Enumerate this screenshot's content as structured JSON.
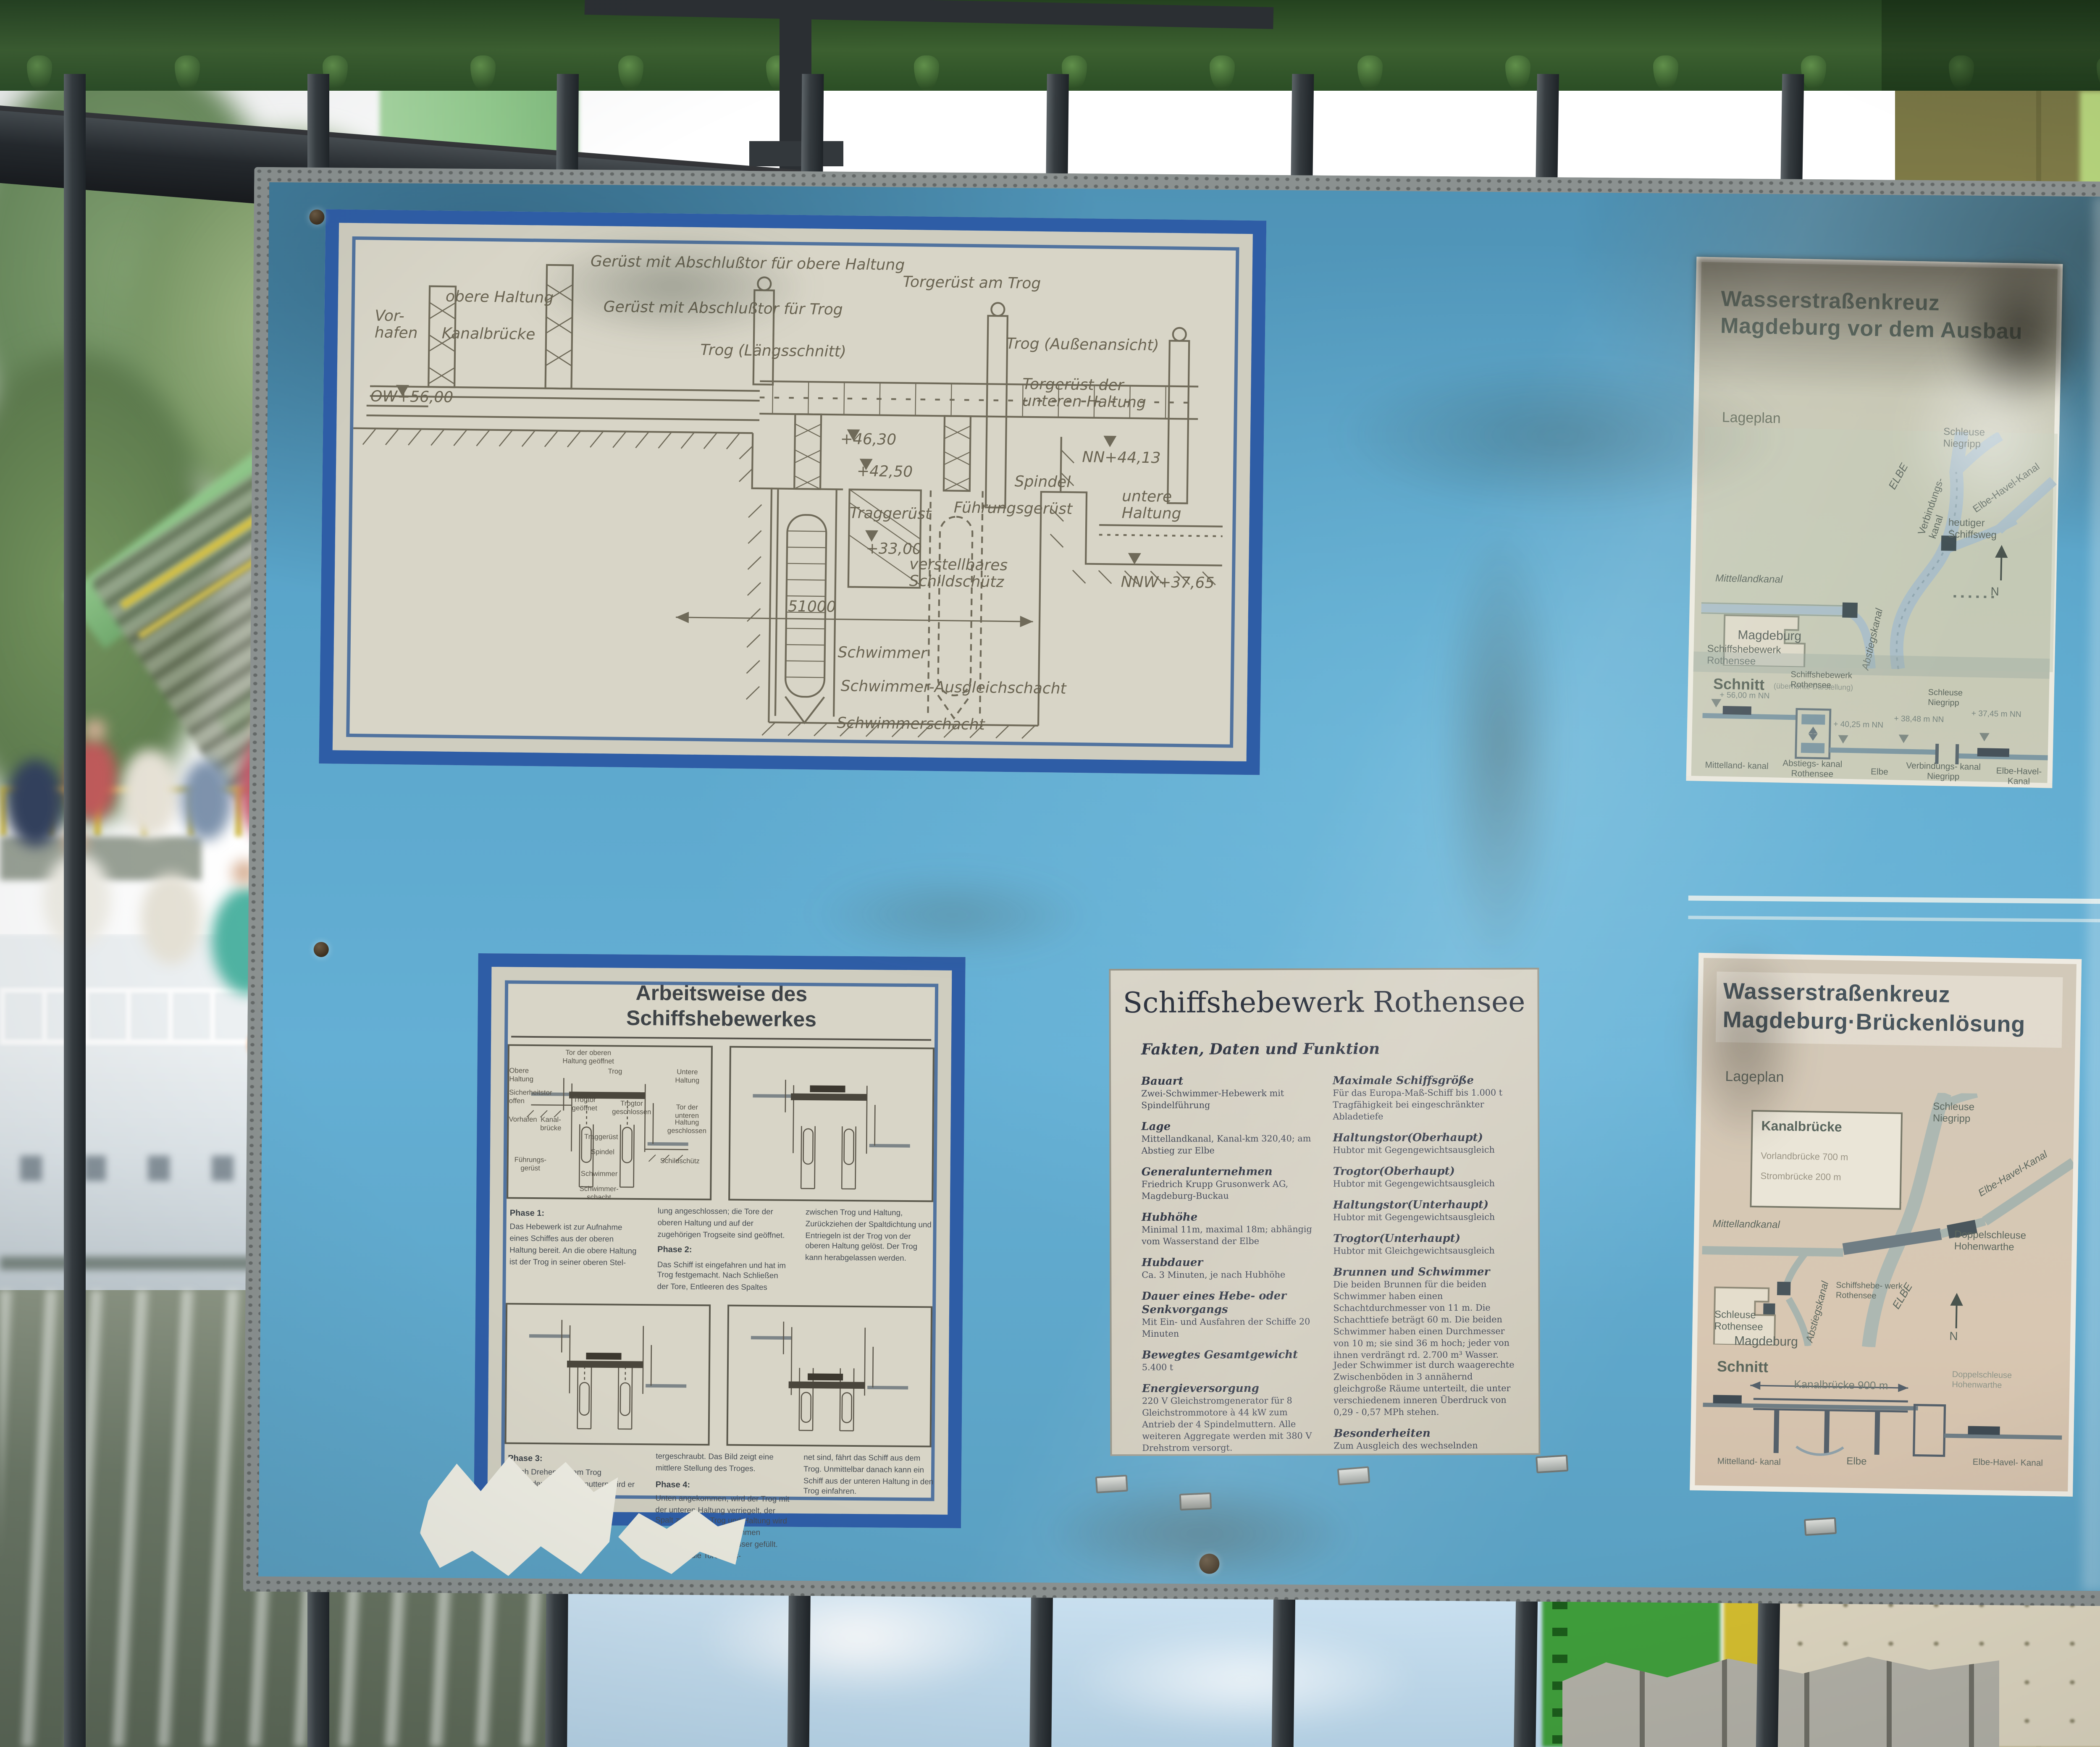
{
  "colors": {
    "board_blue": "#5aa5ca",
    "panel_border_blue": "#2e5da6",
    "girder_green": "#33552a",
    "pylon_green": "#9cd096",
    "wall_olive": "#8a8348",
    "bar_dark": "#2c3236",
    "water_olive": "#6f7b68"
  },
  "board": {
    "drawing": {
      "labels": [
        "Gerüst mit Abschlußtor für obere Haltung",
        "Gerüst mit Abschlußtor für Trog",
        "obere Haltung",
        "Kanalbrücke",
        "Vor-hafen",
        "Trog (Längsschnitt)",
        "Trog (Außenansicht)",
        "Torgerüst am Trog",
        "Torgerüst der unteren Haltung",
        "OW+56,00",
        "+46,30",
        "+42,50",
        "Spindel",
        "Traggerüst",
        "Führungsgerüst",
        "+33,00",
        "51000",
        "Schwimmer",
        "Schwimmer-Ausgleichschacht",
        "Schwimmerschacht",
        "untere Haltung",
        "verstellbares Schildschütz",
        "NN+44,13",
        "NNW+37,65"
      ]
    },
    "ausbau": {
      "title1": "Wasserstraßenkreuz",
      "title2": "Magdeburg vor dem Ausbau",
      "lageplan": "Lageplan",
      "map_labels": [
        "ELBE",
        "Schleuse Niegripp",
        "Verbindungs- kanal",
        "Elbe-Havel-Kanal",
        "Mittellandkanal",
        "Schiffshebewerk Rothensee",
        "Abstiegskanal",
        "Magdeburg",
        "heutiger Schiffsweg",
        "N"
      ],
      "schnitt": "Schnitt",
      "schnitt_note": "(überhöhte Darstellung)",
      "schnitt_labels": [
        "Schiffshebewerk Rothensee",
        "Schleuse Niegripp"
      ],
      "levels": [
        "+ 56,00 m NN",
        "+ 40,25 m NN",
        "+ 38,48 m NN",
        "+ 37,45 m NN"
      ],
      "bottom_labels": [
        "Mittelland- kanal",
        "Abstiegs- kanal Rothensee",
        "Elbe",
        "Verbindungs- kanal Niegripp",
        "Elbe-Havel- Kanal"
      ]
    },
    "arbeitsweise": {
      "title1": "Arbeitsweise des",
      "title2": "Schiffshebewerkes",
      "d1_labels": [
        "Tor der oberen Haltung geöffnet",
        "Obere Haltung",
        "Trog",
        "Untere Haltung",
        "Sicherheitstor offen",
        "Vorhafen",
        "Kanal- brücke",
        "Trogtor geöffnet",
        "Trogtor geschlossen",
        "Tor der unteren Haltung geschlossen",
        "Traggerüst",
        "Spindel",
        "Schildschütz",
        "Führungs- gerüst",
        "Schwimmer",
        "Schwimmer- schacht"
      ],
      "phase1_h": "Phase 1:",
      "phase1a": "Das Hebewerk ist zur Aufnahme eines Schiffes aus der oberen Haltung bereit. An die obere Haltung ist der Trog in seiner oberen Stel-",
      "phase1b": "lung angeschlossen; die Tore der oberen Haltung und auf der zugehörigen Trogseite sind geöffnet.",
      "phase2_h": "Phase 2:",
      "phase2a": "Das Schiff ist eingefahren und hat im Trog festgemacht. Nach Schließen der Tore, Entleeren des Spaltes",
      "phase2b": "zwischen Trog und Haltung, Zurückziehen der Spaltdichtung und Entriegeln ist der Trog von der oberen Haltung gelöst. Der Trog kann herabgelassen werden.",
      "phase3_h": "Phase 3:",
      "phase3a": "Durch Drehen der am Trog vorhandenen Spindelmuttern wird er an den vier seitlichen Spindeln herun-",
      "phase3b": "tergeschraubt. Das Bild zeigt eine mittlere Stellung des Troges.",
      "phase4_h": "Phase 4:",
      "phase4a": "Unten angekommen, wird der Trog mit der unteren Haltung verriegelt, der Spalt zwischen Trog und Haltung wird durch einen Dichtungsrahmen abgedichtet und mit Wasser gefüllt. Nachdem die Tore geöff-",
      "phase4b": "net sind, fährt das Schiff aus dem Trog. Unmittelbar danach kann ein Schiff aus der unteren Haltung in den Trog einfahren."
    },
    "rothensee": {
      "title": "Schiffshebewerk Rothensee",
      "subtitle": "Fakten, Daten und Funktion",
      "left": [
        {
          "t": "Bauart",
          "d": "Zwei-Schwimmer-Hebewerk mit Spindelführung"
        },
        {
          "t": "Lage",
          "d": "Mittellandkanal, Kanal-km 320,40; am Abstieg zur Elbe"
        },
        {
          "t": "Generalunternehmen",
          "d": "Friedrich Krupp Grusonwerk AG, Magdeburg-Buckau"
        },
        {
          "t": "Hubhöhe",
          "d": "Minimal 11m, maximal 18m; abhängig vom Wasserstand der Elbe"
        },
        {
          "t": "Hubdauer",
          "d": "Ca. 3 Minuten, je nach Hubhöhe"
        },
        {
          "t": "Dauer eines Hebe- oder Senkvorgangs",
          "d": "Mit Ein- und Ausfahren der Schiffe 20 Minuten"
        },
        {
          "t": "Bewegtes Gesamtgewicht",
          "d": "5.400 t"
        },
        {
          "t": "Energieversorgung",
          "d": "220 V Gleichstromgenerator für 8 Gleichstrommotore à 44 kW zum Antrieb der 4 Spindelmuttern. Alle weiteren Aggregate werden mit 380 V Drehstrom versorgt."
        },
        {
          "t": "Antrieb",
          "d": "Der Antrieb erfolgt über vier Antriebsmuttern am Trog, die auf den vier feststehenden Gewindespindeln (27,30 m lang) gleiten. Die gleichmäßige Drehung der Antriebsmuttern bewirkt die Auf- oder Abwärtsbewegung des Trogs."
        },
        {
          "t": "Troggröße",
          "d": "85 m lang, 12 m breit, 2,50 m Wassertiefe im Trog"
        },
        {
          "t": "Nutzgröße",
          "d": "82 m x 9,5 m x 2 m"
        }
      ],
      "right": [
        {
          "t": "Maximale Schiffsgröße",
          "d": "Für das Europa-Maß-Schiff bis 1.000 t Tragfähigkeit bei eingeschränkter Abladetiefe"
        },
        {
          "t": "Haltungstor(Oberhaupt)",
          "d": "Hubtor mit Gegengewichtsausgleich"
        },
        {
          "t": "Trogtor(Oberhaupt)",
          "d": "Hubtor mit Gegengewichtsausgleich"
        },
        {
          "t": "Haltungstor(Unterhaupt)",
          "d": "Hubtor mit Gegengewichtsausgleich"
        },
        {
          "t": "Trogtor(Unterhaupt)",
          "d": "Hubtor mit Gleichgewichtsausgleich"
        },
        {
          "t": "Brunnen und Schwimmer",
          "d": "Die beiden Brunnen für die beiden Schwimmer haben einen Schachtdurchmesser von 11 m. Die Schachttiefe beträgt 60 m. Die beiden Schwimmer haben einen Durchmesser von 10 m; sie sind 36 m hoch; jeder von ihnen verdrängt rd. 2.700 m³ Wasser. Jeder Schwimmer ist durch waagerechte Zwischenböden in 3 annähernd gleichgroße Räume unterteilt, die unter verschiedenem inneren Überdruck von 0,29 - 0,57 MPh stehen."
        },
        {
          "t": "Besonderheiten",
          "d": "Zum Ausgleich des wechselnden Elbwasserstands ist ein verstellbares Schildschütz mit 7 Stufen vorhanden; dadurch wird die Trogkammer gegen das Unterwasser abgeschlossen. Ohne diese Einrichtung hätte das elbseitige Haltungstor 10 m hoch, das Führungsportal für dieses Tor sogar über 25 m hoch sein müssen."
        },
        {
          "t": "Bauzeit",
          "d": "Beginn der Aufschluß- und Gründungsarbeiten Ende der 20er Jahre; Montage der Stahlkonstruktion und der Maschinenanlage 1934 - 1938"
        },
        {
          "t": "Einweihung",
          "d": "31.10.1938"
        }
      ]
    },
    "brueckenloesung": {
      "title1": "Wasserstraßenkreuz",
      "title2": "Magdeburg·Brückenlösung",
      "lageplan": "Lageplan",
      "box_title": "Kanalbrücke",
      "box_line1": "Vorlandbrücke 700 m",
      "box_line2": "Strombrücke 200 m",
      "map_labels": [
        "Schleuse Niegripp",
        "Elbe-Havel-Kanal",
        "Mittellandkanal",
        "Doppelschleuse Hohenwarthe",
        "Schiffshebe- werk Rothensee",
        "Schleuse Rothensee",
        "Abstiegskanal",
        "Magdeburg",
        "ELBE",
        "N"
      ],
      "schnitt": "Schnitt",
      "bridge_dim": "Kanalbrücke 900 m",
      "schnitt_labels": [
        "Doppelschleuse Hohenwarthe",
        "Elbe",
        "Elbe-Havel- Kanal",
        "Mittelland- kanal"
      ]
    }
  }
}
